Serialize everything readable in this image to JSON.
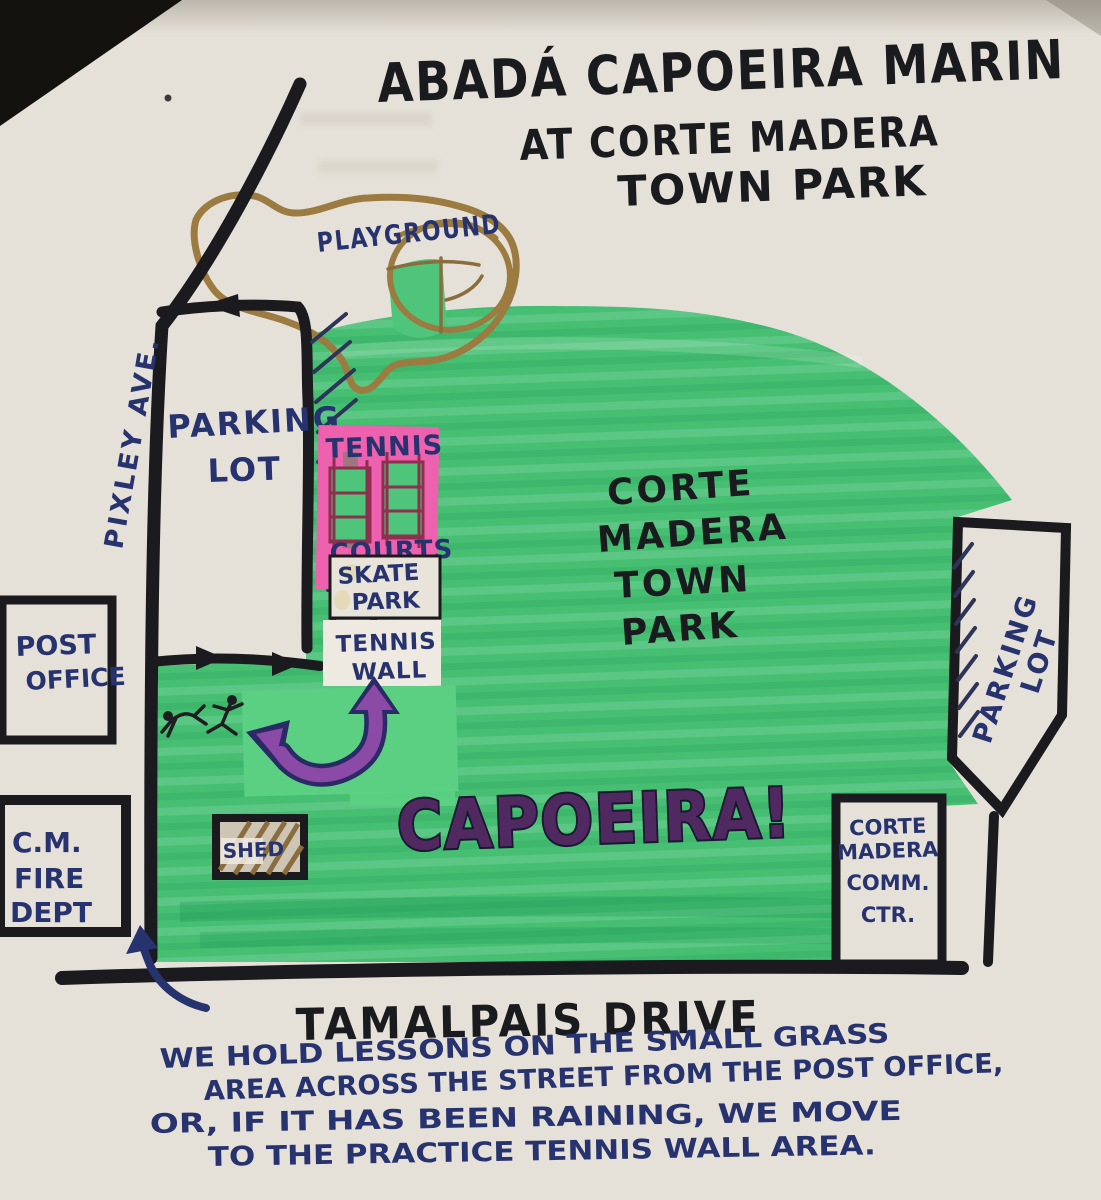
{
  "title": {
    "line1": "ABADÁ CAPOEIRA MARIN",
    "line2": "AT CORTE MADERA",
    "line3": "TOWN PARK"
  },
  "streets": {
    "pixley": "PIXLEY AVE.",
    "tamalpais": "TAMALPAIS DRIVE"
  },
  "park": {
    "name": {
      "line1": "CORTE",
      "line2": "MADERA",
      "line3": "TOWN",
      "line4": "PARK"
    },
    "capoeira": "CAPOEIRA!",
    "playground": "PLAYGROUND",
    "shed": "SHED",
    "tennis_courts": {
      "line1": "TENNIS",
      "line2": "COURTS"
    },
    "skate_park": {
      "line1": "SKATE",
      "line2": "PARK"
    },
    "tennis_wall": {
      "line1": "TENNIS",
      "line2": "WALL"
    },
    "west_parking": {
      "line1": "PARKING",
      "line2": "LOT"
    },
    "east_parking": {
      "line1": "PARKING",
      "line2": "LOT"
    }
  },
  "buildings": {
    "post_office": {
      "line1": "POST",
      "line2": "OFFICE"
    },
    "fire_dept": {
      "line1": "C.M.",
      "line2": "FIRE",
      "line3": "DEPT"
    },
    "community_center": {
      "line1": "CORTE",
      "line2": "MADERA",
      "line3": "COMM.",
      "line4": "CTR."
    }
  },
  "note": {
    "line1": "WE HOLD LESSONS ON THE SMALL GRASS",
    "line2": "AREA ACROSS THE STREET FROM THE POST OFFICE,",
    "line3": "OR, IF IT HAS BEEN RAINING, WE MOVE",
    "line4": "TO THE PRACTICE TENNIS WALL AREA."
  },
  "colors": {
    "paper": "#e6e1d8",
    "grass": "#46bf73",
    "grass_patch": "#5bd083",
    "road_black": "#1b1b1f",
    "ink_navy": "#27336e",
    "ink_black": "#1a1b1f",
    "court_pink": "#ee61ae",
    "court_line_maroon": "#8f2f4f",
    "arrow_purple": "#8b4aa6",
    "capoeira_purple": "#4f2960",
    "playground_brown": "#9c7b41"
  }
}
